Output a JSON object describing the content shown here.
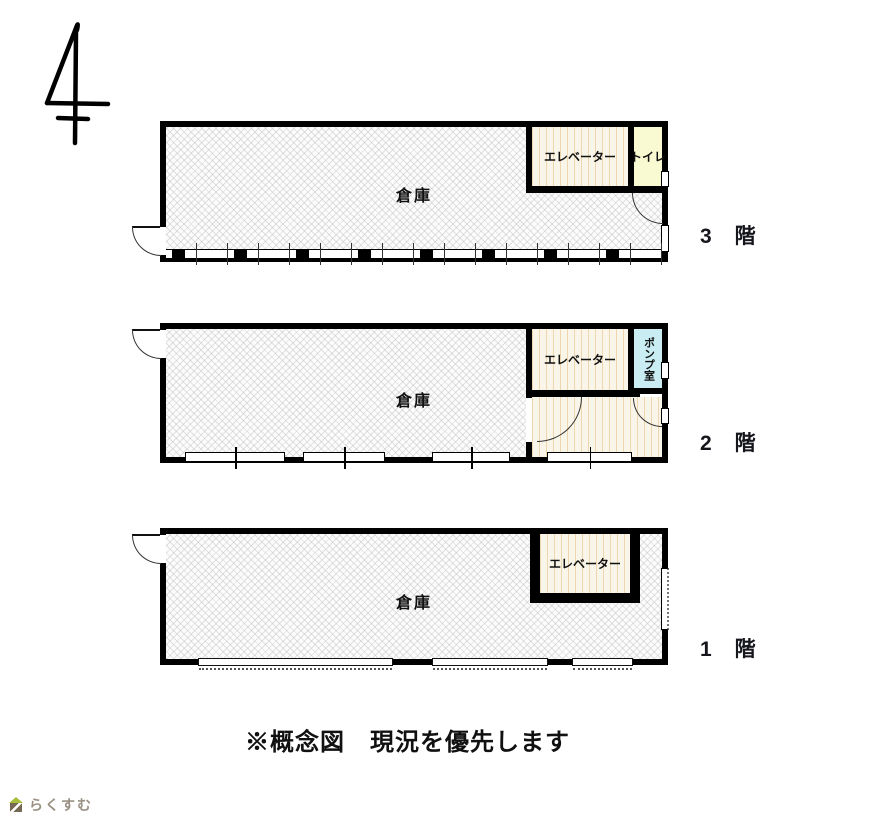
{
  "note": "※概念図　現況を優先します",
  "logo": {
    "text": "らくすむ"
  },
  "floors": [
    {
      "id": "3F",
      "label": "3　階",
      "rooms": {
        "warehouse": "倉庫",
        "elevator": "エレベーター",
        "toilet": "トイレ"
      }
    },
    {
      "id": "2F",
      "label": "2　階",
      "rooms": {
        "warehouse": "倉庫",
        "elevator": "エレベーター",
        "pump": "ポンプ室"
      }
    },
    {
      "id": "1F",
      "label": "1　階",
      "rooms": {
        "warehouse": "倉庫",
        "elevator": "エレベーター"
      }
    }
  ],
  "colors": {
    "wall": "#000000",
    "toilet_fill": "#fafad2",
    "pump_fill": "#c9edf3",
    "elevator_stripe": "#eed6af",
    "logo_text": "#9a9184",
    "logo_roof": "#a8bf3a"
  }
}
